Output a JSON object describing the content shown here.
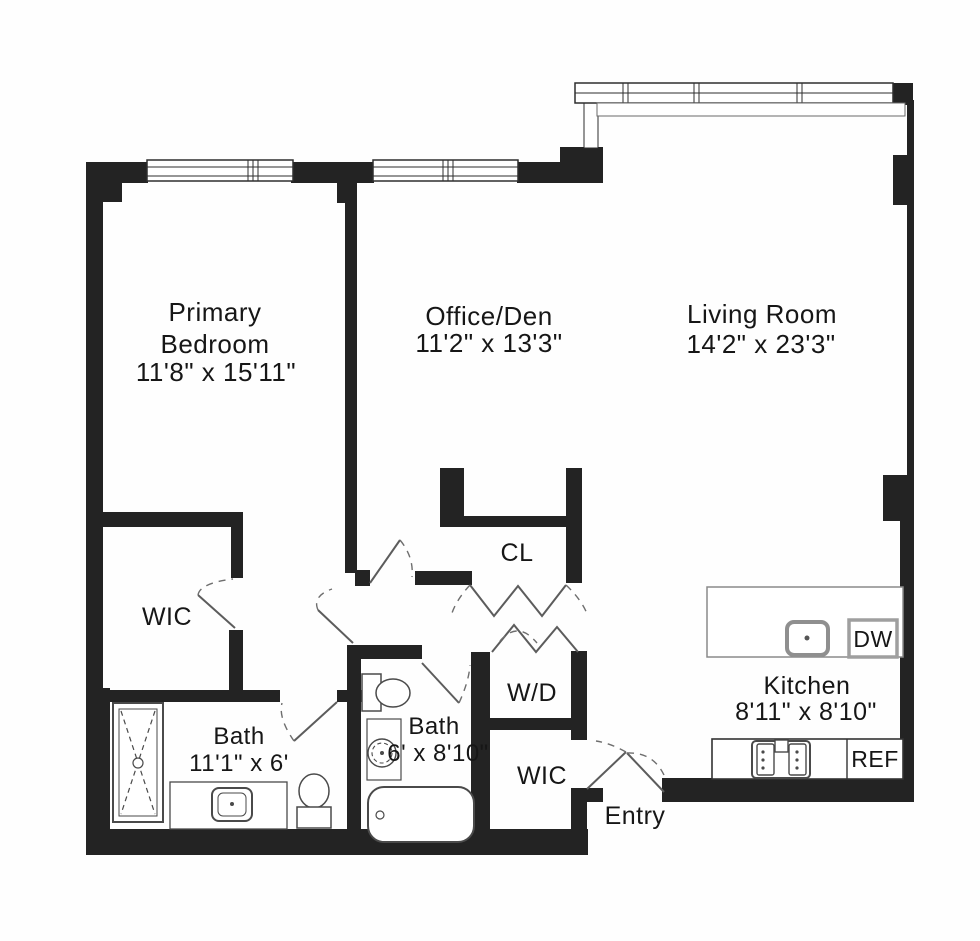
{
  "plan_type": "apartment-floor-plan",
  "rooms": {
    "primary_bedroom": {
      "line1": "Primary",
      "line2": "Bedroom",
      "dims": "11'8\" x 15'11\""
    },
    "office_den": {
      "name": "Office/Den",
      "dims": "11'2\" x 13'3\""
    },
    "living_room": {
      "name": "Living Room",
      "dims": "14'2\" x 23'3\""
    },
    "kitchen": {
      "name": "Kitchen",
      "dims": "8'11\" x 8'10\"",
      "dishwasher_label": "DW",
      "refrigerator_label": "REF"
    },
    "bath_primary": {
      "name": "Bath",
      "dims": "11'1\" x 6'"
    },
    "bath_second": {
      "name": "Bath",
      "dims": "6' x 8'10\""
    },
    "wic_primary": {
      "name": "WIC"
    },
    "wic_entry": {
      "name": "WIC"
    },
    "closet": {
      "name": "CL"
    },
    "laundry": {
      "name": "W/D"
    },
    "entry": {
      "name": "Entry"
    }
  },
  "colors": {
    "wall": "#232323",
    "thin_line": "#2e2e2e",
    "fixture_line": "#4a4a4a",
    "counter_gray": "#8a8a8a",
    "text": "#161616",
    "background": "#fefefe"
  }
}
